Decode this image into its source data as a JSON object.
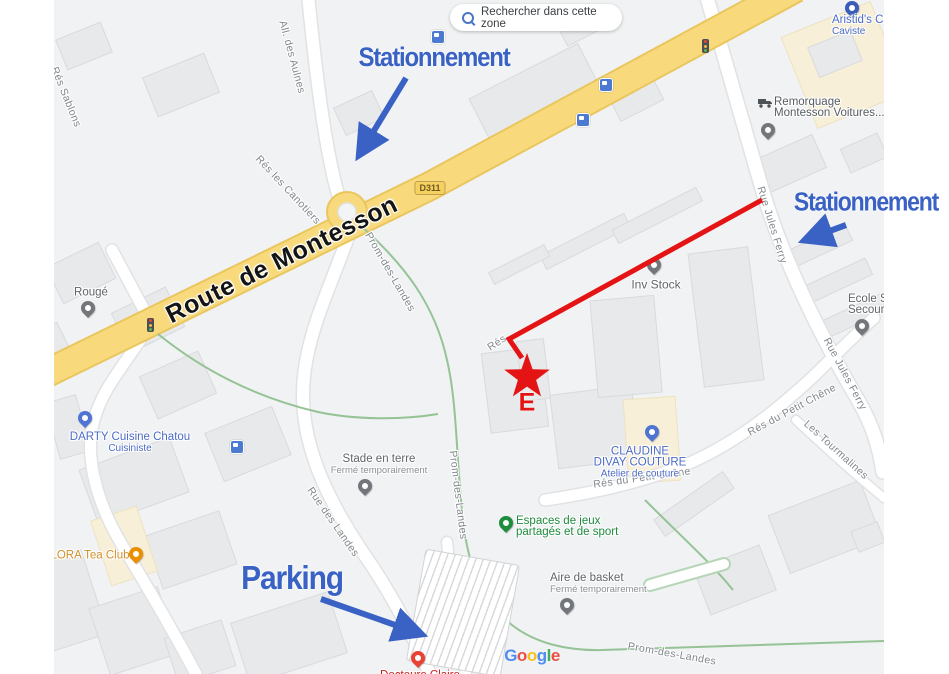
{
  "colors": {
    "annotation_blue": "#3a62c5",
    "annotation_red": "#e51414",
    "road_yellow": "#f8da7d",
    "poi_blue": "#4d6bc6",
    "poi_green": "#1d8a3d",
    "poi_amber": "#d2902a",
    "street_gray": "#82878c"
  },
  "icons": {
    "search_chip_icon": "magnifier",
    "bus_stop_icon": "bus",
    "traffic_light_icon": "traffic-light",
    "tow_truck_icon": "tow-truck",
    "destination_icon": "red-star"
  },
  "search_chip": {
    "label": "Rechercher dans cette zone"
  },
  "annotations": {
    "stationnement_top": "Stationnement",
    "stationnement_right": "Stationnement",
    "parking": "Parking",
    "marker_letter": "E"
  },
  "roads": {
    "route_de_montesson": "Route de Montesson",
    "d311": "D311"
  },
  "streets": {
    "all_des_aulnes": "All. des Aulnes",
    "res_les_canotiers": "Rés les Canotiers",
    "res_sablons": "Rés Sablons",
    "rue_des_landes": "Rue des Landes",
    "prom_des_landes": "Prom-des-Landes",
    "rue_jules_ferry": "Rue Jules Ferry",
    "res_du_petit_chene": "Rés du Petit Chêne",
    "les_tourmalines": "Les Tourmalines",
    "res_fragment": "Rés"
  },
  "pois": {
    "aristids": {
      "name": "Aristid's Ca",
      "sub": "Caviste"
    },
    "remorquage": {
      "line1": "Remorquage",
      "line2": "Montesson Voitures..."
    },
    "rouge": {
      "name": "Rougé"
    },
    "inv_stock": {
      "name": "Inv Stock"
    },
    "darty": {
      "name": "DARTY Cuisine Chatou",
      "sub": "Cuisiniste"
    },
    "claudine": {
      "line1": "CLAUDINE",
      "line2": "DIVAY COUTURE",
      "sub": "Atelier de couture"
    },
    "lora": {
      "name": "LORA Tea Club"
    },
    "stade": {
      "name": "Stade en terre",
      "sub": "Fermé temporairement"
    },
    "espaces": {
      "line1": "Espaces de jeux",
      "line2": "partagés et de sport"
    },
    "aire_de_basket": {
      "name": "Aire de basket",
      "sub": "Fermé temporairement"
    },
    "ecole": {
      "line1": "Ecole S",
      "line2": "Secour"
    },
    "docteure": {
      "name": "Docteure Claire"
    }
  },
  "watermark": {
    "letters": [
      "G",
      "o",
      "o",
      "g",
      "l",
      "e"
    ]
  }
}
